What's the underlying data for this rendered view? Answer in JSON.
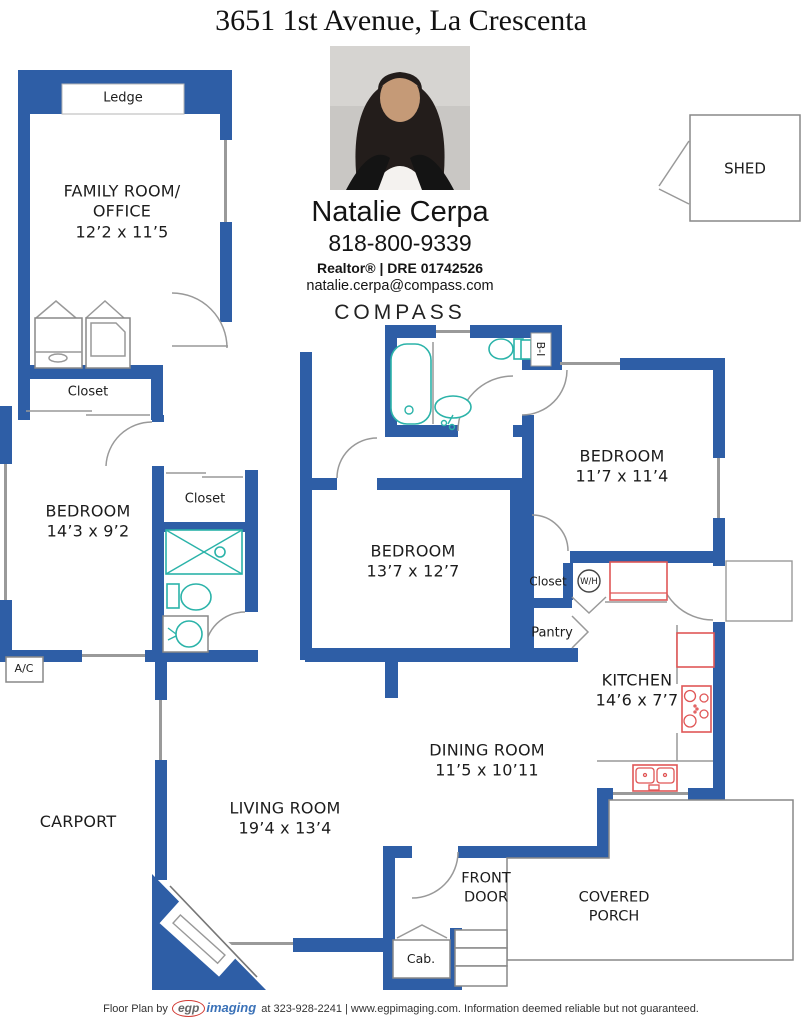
{
  "title": "3651 1st Avenue, La Crescenta",
  "agent": {
    "name": "Natalie Cerpa",
    "phone": "818-800-9339",
    "credentials": "Realtor® | DRE 01742526",
    "email": "natalie.cerpa@compass.com",
    "brand": "COMPASS"
  },
  "rooms": {
    "family": {
      "name": "FAMILY ROOM/ OFFICE",
      "dims": "12’2 x 11’5"
    },
    "bedroom_left": {
      "name": "BEDROOM",
      "dims": "14’3 x 9’2"
    },
    "bedroom_middle": {
      "name": "BEDROOM",
      "dims": "13’7 x 12’7"
    },
    "bedroom_right": {
      "name": "BEDROOM",
      "dims": "11’7 x 11’4"
    },
    "kitchen": {
      "name": "KITCHEN",
      "dims": "14’6 x 7’7"
    },
    "dining": {
      "name": "DINING ROOM",
      "dims": "11’5 x 10’11"
    },
    "living": {
      "name": "LIVING ROOM",
      "dims": "19’4 x 13’4"
    },
    "carport": {
      "name": "CARPORT"
    },
    "front_door": {
      "name": "FRONT DOOR"
    },
    "covered_porch": {
      "name": "COVERED PORCH"
    },
    "shed": {
      "name": "SHED"
    }
  },
  "labels": {
    "ledge": "Ledge",
    "closet_family": "Closet",
    "closet_hall": "Closet",
    "closet_bedroom": "Closet",
    "pantry": "Pantry",
    "water_heater": "W/H",
    "built_in": "B-I",
    "ac": "A/C",
    "cabinet": "Cab."
  },
  "footer": {
    "prefix": "Floor Plan by",
    "logo_egp": "egp",
    "logo_imaging": "imaging",
    "suffix": "at 323-928-2241 | www.egpimaging.com. Information deemed reliable but not guaranteed."
  },
  "colors": {
    "wall": "#2E5EA6",
    "fixture": "#2BB3A9",
    "appliance": "#E05656"
  }
}
